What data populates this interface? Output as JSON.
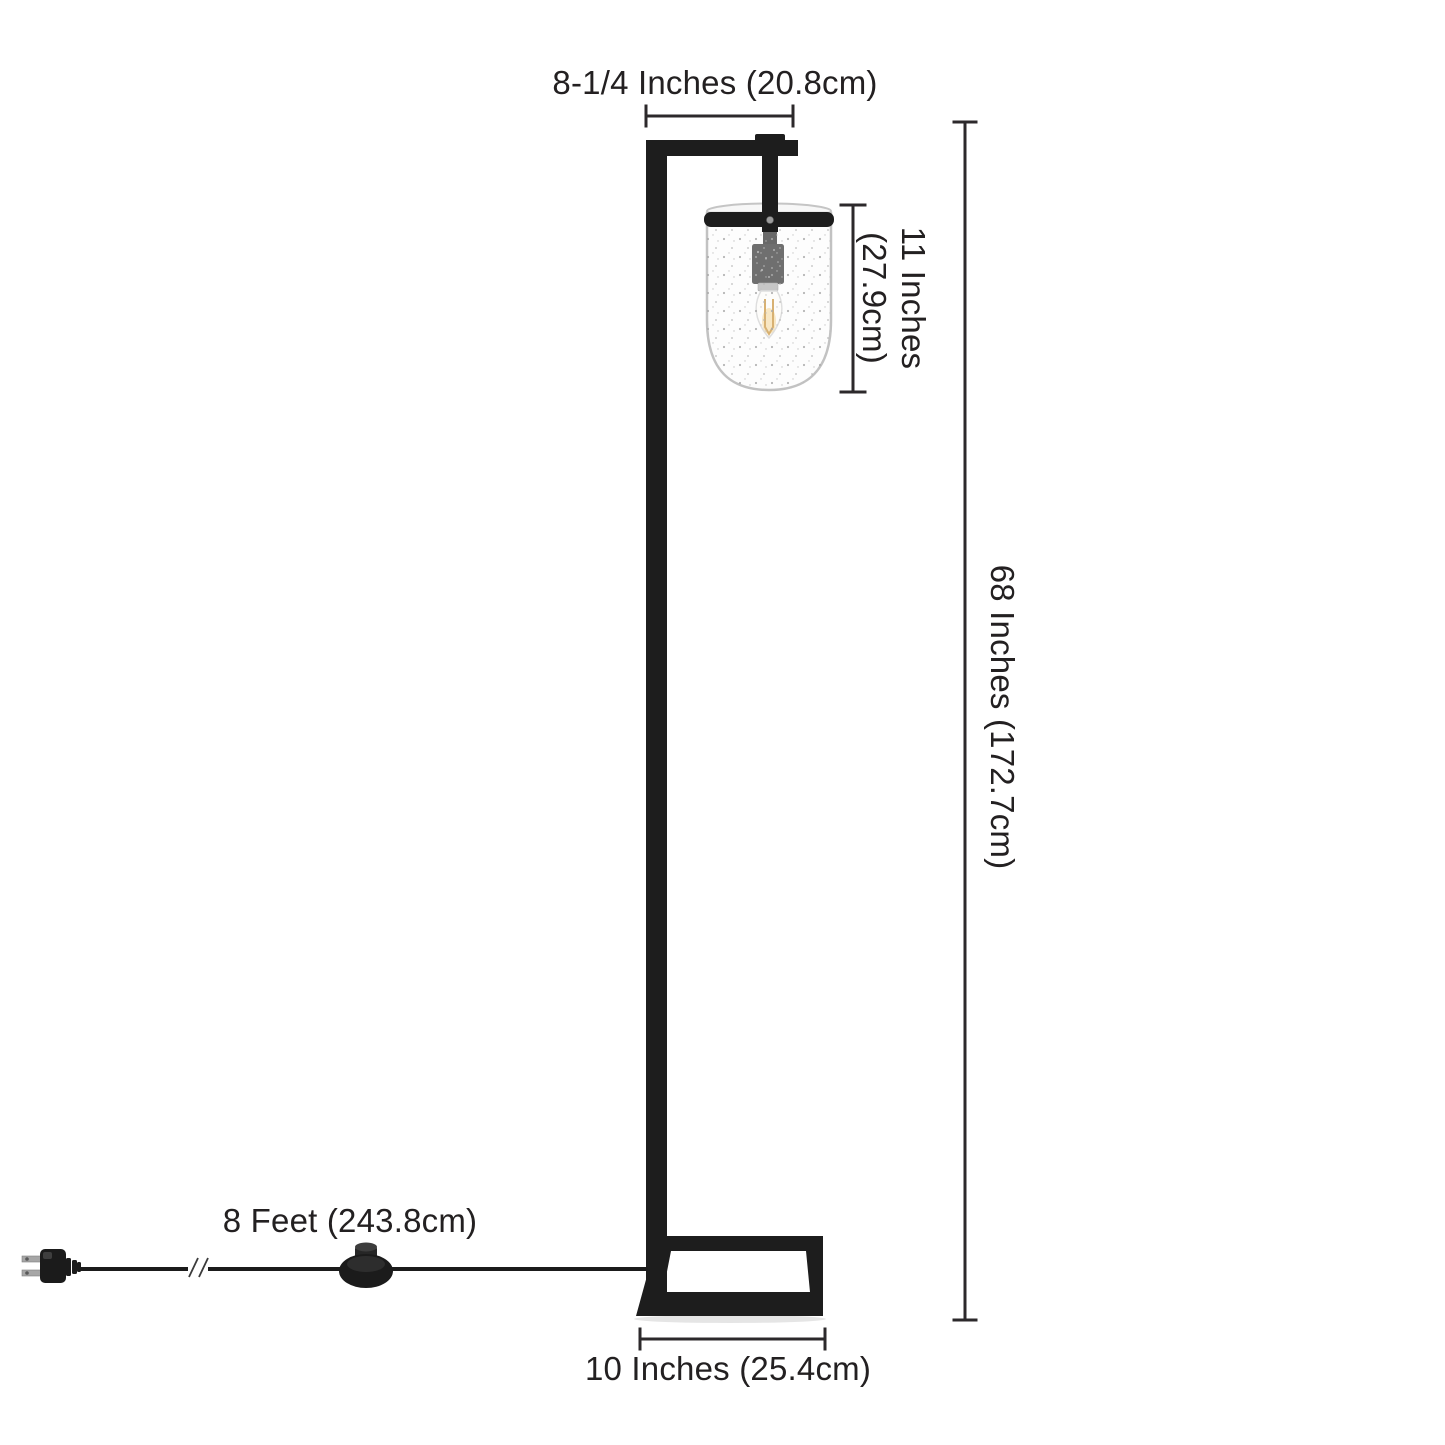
{
  "diagram": {
    "title": "Floor lamp dimension diagram",
    "background": "#ffffff",
    "colors": {
      "metal_black": "#1d1d1d",
      "dimension_line": "#2c292b",
      "label_text": "#232021",
      "glass_outline": "#c2c2c2",
      "filament_amber": "#c68a2a",
      "socket_collar": "#ababab"
    },
    "labels": {
      "shade_width": "8-1/4 Inches (20.8cm)",
      "shade_height_line1": "11 Inches",
      "shade_height_line2": "(27.9cm)",
      "lamp_height": "68 Inches (172.7cm)",
      "cord_length": "8 Feet (243.8cm)",
      "base_width": "10 Inches (25.4cm)"
    }
  }
}
